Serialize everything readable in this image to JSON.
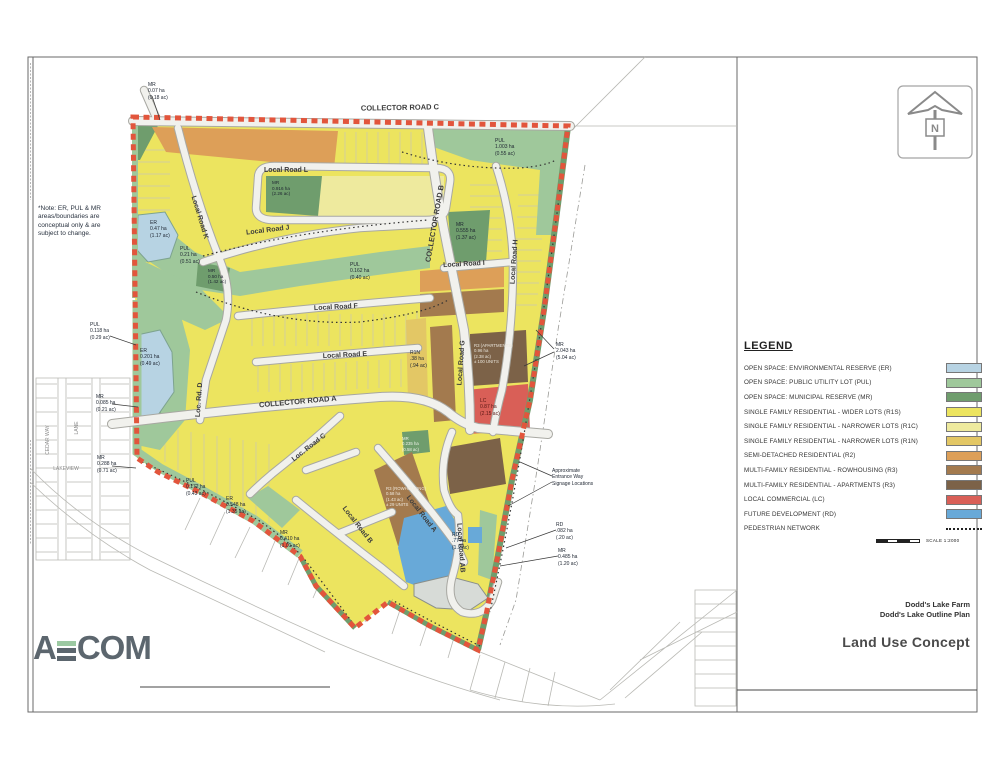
{
  "title_block": {
    "project": "Dodd's Lake Farm",
    "subtitle": "Dodd's Lake Outline Plan",
    "sheet_title": "Land Use Concept"
  },
  "logo": {
    "letter_a": "A",
    "letters_com": "COM",
    "accent_color": "#9cc9a2"
  },
  "north_arrow": {
    "label": "N"
  },
  "scale_bar": {
    "label": "SCALE 1:2000"
  },
  "note": {
    "text": "*Note: ER, PUL & MR\nareas/boundaries are\nconceptual only & are\nsubject to change."
  },
  "legend": {
    "title": "LEGEND",
    "items": [
      {
        "label": "OPEN SPACE: ENVIRONMENTAL RESERVE (ER)",
        "color": "#b7d3e3"
      },
      {
        "label": "OPEN SPACE: PUBLIC UTILITY LOT (PUL)",
        "color": "#9fc89b"
      },
      {
        "label": "OPEN SPACE: MUNICIPAL RESERVE (MR)",
        "color": "#6f9d6d"
      },
      {
        "label": "SINGLE FAMILY RESIDENTIAL - WIDER LOTS (R1S)",
        "color": "#ece45f"
      },
      {
        "label": "SINGLE FAMILY RESIDENTIAL - NARROWER LOTS (R1C)",
        "color": "#eeea9e"
      },
      {
        "label": "SINGLE FAMILY RESIDENTIAL - NARROWER LOTS (R1N)",
        "color": "#e3c765"
      },
      {
        "label": "SEMI-DETACHED RESIDENTIAL (R2)",
        "color": "#dd9f58"
      },
      {
        "label": "MULTI-FAMILY RESIDENTIAL - ROWHOUSING (R3)",
        "color": "#a37a4e"
      },
      {
        "label": "MULTI-FAMILY RESIDENTIAL - APARTMENTS (R3)",
        "color": "#7c6248"
      },
      {
        "label": "LOCAL COMMERCIAL (LC)",
        "color": "#d95f57"
      },
      {
        "label": "FUTURE DEVELOPMENT (RD)",
        "color": "#68a9d8"
      },
      {
        "label": "PEDESTRIAN NETWORK",
        "color": ""
      }
    ]
  },
  "map": {
    "boundary_color": "#e2553c",
    "road_labels": [
      {
        "text": "COLLECTOR ROAD C"
      },
      {
        "text": "Local Road L"
      },
      {
        "text": "Local Road K"
      },
      {
        "text": "Local Road J"
      },
      {
        "text": "COLLECTOR ROAD B"
      },
      {
        "text": "Local Road I"
      },
      {
        "text": "Local Road H"
      },
      {
        "text": "Local Road F"
      },
      {
        "text": "Local Road E"
      },
      {
        "text": "Local Road G"
      },
      {
        "text": "COLLECTOR ROAD A"
      },
      {
        "text": "Loc. Road C"
      },
      {
        "text": "Loc. Rd. D"
      },
      {
        "text": "Local Road B"
      },
      {
        "text": "Local Road A"
      },
      {
        "text": "Local Road AB"
      }
    ],
    "context_labels": [
      {
        "text": "CEDAR WAY"
      },
      {
        "text": "LANE"
      },
      {
        "text": "LAKEVIEW"
      }
    ],
    "area_labels": [
      {
        "text": "MR\n0.07 ha\n(0.18 ac)"
      },
      {
        "text": "PUL\n1.003 ha\n(0.55 ac)"
      },
      {
        "text": "ER\n0.47 ha\n(1.17 ac)"
      },
      {
        "text": "PUL\n0.21 ha\n(0.51 ac)"
      },
      {
        "text": "MR\n0.916 ha\n(2.26 ac)"
      },
      {
        "text": "MR\n0.555 ha\n(1.37 ac)"
      },
      {
        "text": "PUL\n0.162 ha\n(0.40 ac)"
      },
      {
        "text": "MR\n0.50 ha\n(1.42 ac)"
      },
      {
        "text": "PUL\n0.118 ha\n(0.29 ac)"
      },
      {
        "text": "ER\n0.201 ha\n(0.49 ac)"
      },
      {
        "text": "MR\n0.085 ha\n(0.21 ac)"
      },
      {
        "text": "MR\n0.288 ha\n(0.71 ac)"
      },
      {
        "text": "R1N\n.38 ha\n(.94 ac)"
      },
      {
        "text": "R3 (APARTMENTS)\n0.96 ha\n(2.38 ac)\n± 100 UNITS"
      },
      {
        "text": "LC\n0.87 ha\n(2.15 ac)"
      },
      {
        "text": "MR\n2.043 ha\n(5.04 ac)"
      },
      {
        "text": "Approximate\nEntrance Way\nSignage Locations"
      },
      {
        "text": "PUL\n0.172 ha\n(0.43 ac)"
      },
      {
        "text": "ER\n0.548 ha\n(1.35 ac)"
      },
      {
        "text": "MR\n0.410 ha\n(1.01 ac)"
      },
      {
        "text": "R3 (ROWHOUSING)\n0.58 ha\n(1.43 ac)\n± 29 UNITS"
      },
      {
        "text": "RD\n.77 ha\n(1.9 ac)"
      },
      {
        "text": "MR\n0.235 ha\n(0.58 ac)"
      },
      {
        "text": "RD\n.082 ha\n(.20 ac)"
      },
      {
        "text": "MR\n0.485 ha\n(1.20 ac)"
      }
    ]
  }
}
